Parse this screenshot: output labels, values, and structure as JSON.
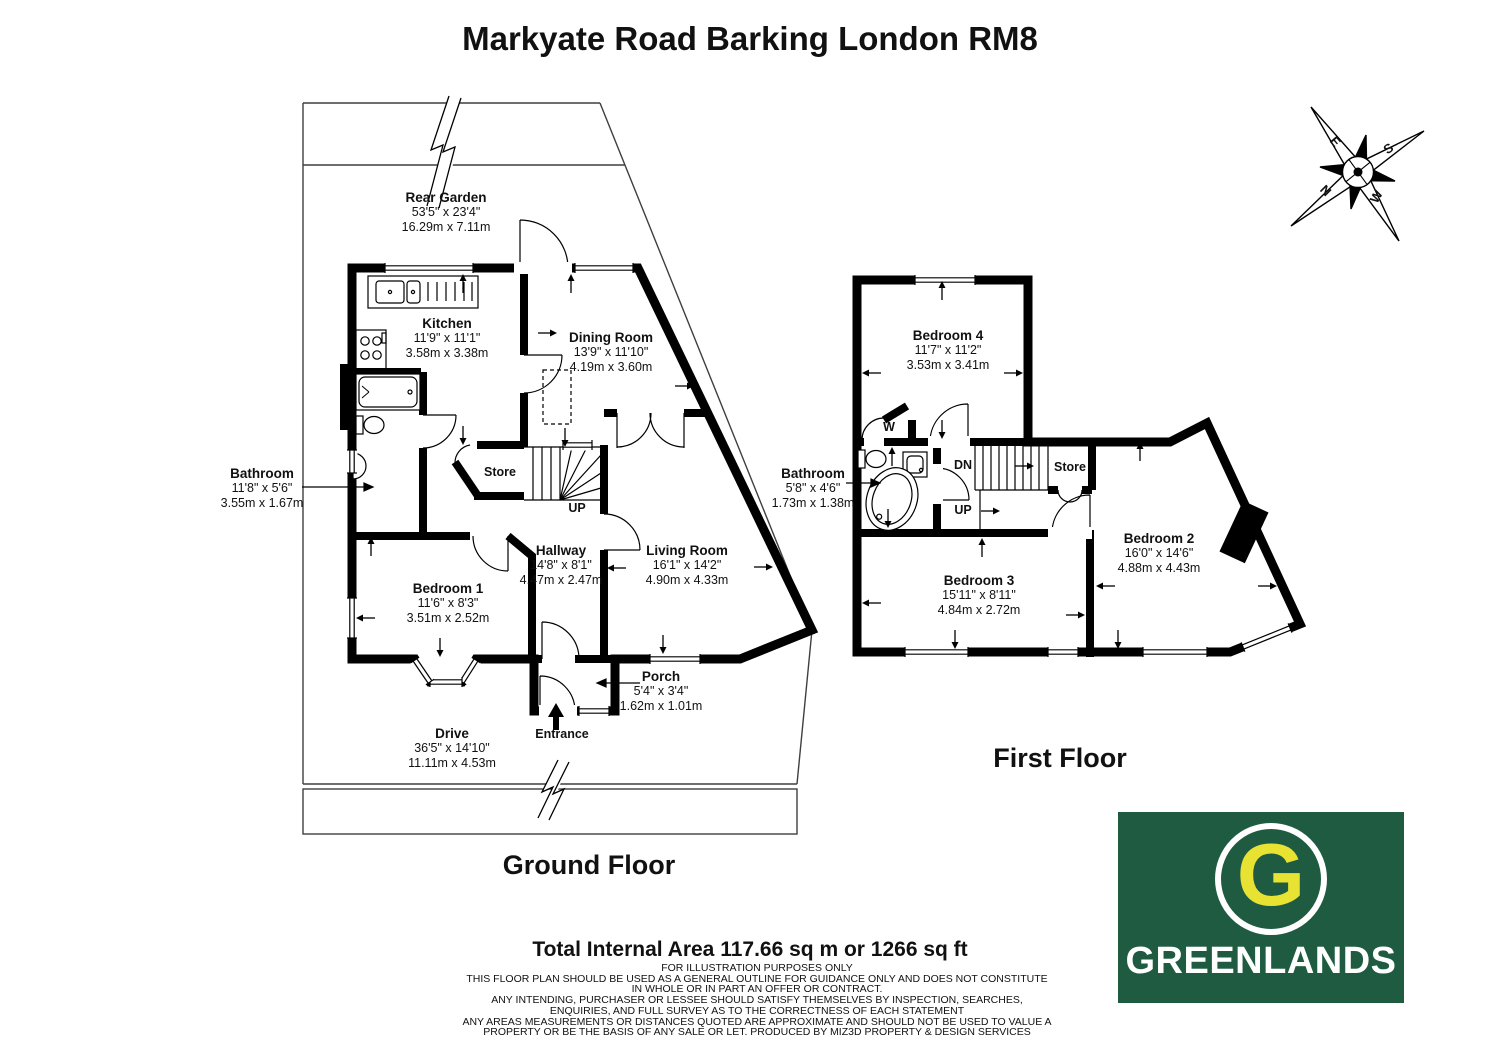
{
  "page": {
    "title": "Markyate Road Barking London RM8"
  },
  "ground_floor": {
    "title": "Ground Floor",
    "rooms": [
      {
        "name": "Rear Garden",
        "dims_imperial": "53'5\" x 23'4\"",
        "dims_metric": "16.29m x 7.11m"
      },
      {
        "name": "Kitchen",
        "dims_imperial": "11'9\" x 11'1\"",
        "dims_metric": "3.58m x 3.38m"
      },
      {
        "name": "Dining Room",
        "dims_imperial": "13'9\" x 11'10\"",
        "dims_metric": "4.19m x 3.60m"
      },
      {
        "name": "Bathroom",
        "dims_imperial": "11'8\" x 5'6\"",
        "dims_metric": "3.55m x 1.67m"
      },
      {
        "name": "Hallway",
        "dims_imperial": "14'8\" x 8'1\"",
        "dims_metric": "4.47m x 2.47m"
      },
      {
        "name": "Bedroom 1",
        "dims_imperial": "11'6\" x 8'3\"",
        "dims_metric": "3.51m x 2.52m"
      },
      {
        "name": "Living Room",
        "dims_imperial": "16'1\" x 14'2\"",
        "dims_metric": "4.90m x 4.33m"
      },
      {
        "name": "Porch",
        "dims_imperial": "5'4\" x 3'4\"",
        "dims_metric": "1.62m x 1.01m"
      },
      {
        "name": "Drive",
        "dims_imperial": "36'5\" x 14'10\"",
        "dims_metric": "11.11m x 4.53m"
      }
    ],
    "labels": {
      "store": "Store",
      "up": "UP",
      "entrance": "Entrance"
    }
  },
  "first_floor": {
    "title": "First Floor",
    "rooms": [
      {
        "name": "Bedroom 4",
        "dims_imperial": "11'7\" x 11'2\"",
        "dims_metric": "3.53m x 3.41m"
      },
      {
        "name": "Bathroom",
        "dims_imperial": "5'8\" x 4'6\"",
        "dims_metric": "1.73m x 1.38m"
      },
      {
        "name": "Bedroom 2",
        "dims_imperial": "16'0\" x 14'6\"",
        "dims_metric": "4.88m x 4.43m"
      },
      {
        "name": "Bedroom 3",
        "dims_imperial": "15'11\" x 8'11\"",
        "dims_metric": "4.84m x 2.72m"
      }
    ],
    "labels": {
      "store": "Store",
      "dn": "DN",
      "up": "UP",
      "wardrobe": "W"
    }
  },
  "compass": {
    "n": "N",
    "e": "E",
    "s": "S",
    "w": "W"
  },
  "summary": {
    "total_area": "Total Internal Area 117.66 sq m or 1266 sq ft",
    "disclaimer_lines": [
      "FOR ILLUSTRATION PURPOSES ONLY",
      "THIS FLOOR PLAN SHOULD BE USED AS A GENERAL OUTLINE FOR GUIDANCE ONLY AND DOES NOT CONSTITUTE",
      "IN WHOLE OR IN PART AN OFFER OR CONTRACT.",
      "ANY INTENDING, PURCHASER OR LESSEE SHOULD SATISFY THEMSELVES BY INSPECTION, SEARCHES,",
      "ENQUIRIES, AND FULL SURVEY AS TO THE CORRECTNESS OF EACH STATEMENT",
      "ANY AREAS MEASUREMENTS OR DISTANCES QUOTED ARE APPROXIMATE AND SHOULD NOT BE USED TO VALUE A",
      "PROPERTY OR BE THE BASIS OF ANY SALE OR LET. PRODUCED BY MIZ3D PROPERTY & DESIGN SERVICES"
    ]
  },
  "logo": {
    "letter": "G",
    "name": "GREENLANDS",
    "green": "#1E5B40",
    "yellow": "#E8E332"
  }
}
